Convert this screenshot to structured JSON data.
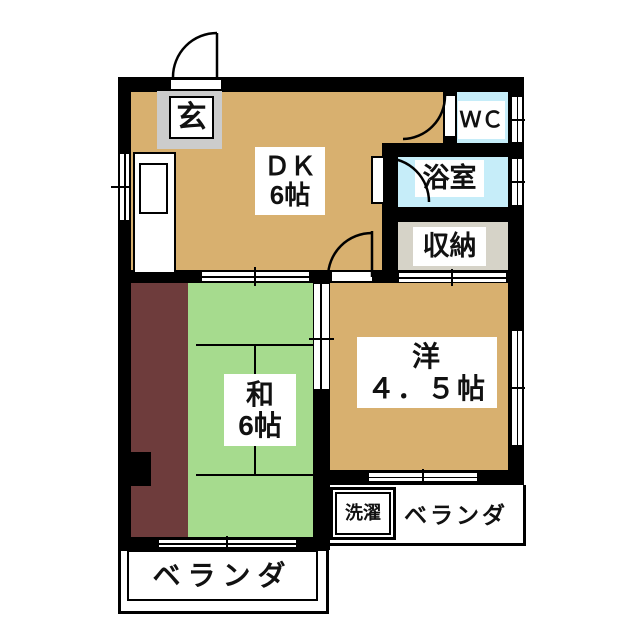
{
  "rooms": {
    "entrance": {
      "label": "玄"
    },
    "dining_kitchen": {
      "label": "ＤＫ",
      "size": "6帖"
    },
    "toilet": {
      "label": "ＷＣ"
    },
    "bathroom": {
      "label": "浴室"
    },
    "storage": {
      "label": "収納"
    },
    "japanese_room": {
      "label": "和",
      "size": "6帖"
    },
    "western_room": {
      "label": "洋",
      "size": "４．５帖"
    },
    "laundry": {
      "label": "洗濯"
    },
    "veranda_right": {
      "label": "ベランダ"
    },
    "veranda_bottom": {
      "label": "ベランダ"
    }
  },
  "colors": {
    "floor_tan": "#d8b06f",
    "tatami_green": "#a6db8e",
    "closet_maroon": "#6e3c3c",
    "water_blue": "#c6edf9",
    "storage_gray": "#d6d3c8",
    "entrance_gray": "#cccccc",
    "wall_black": "#000000"
  }
}
